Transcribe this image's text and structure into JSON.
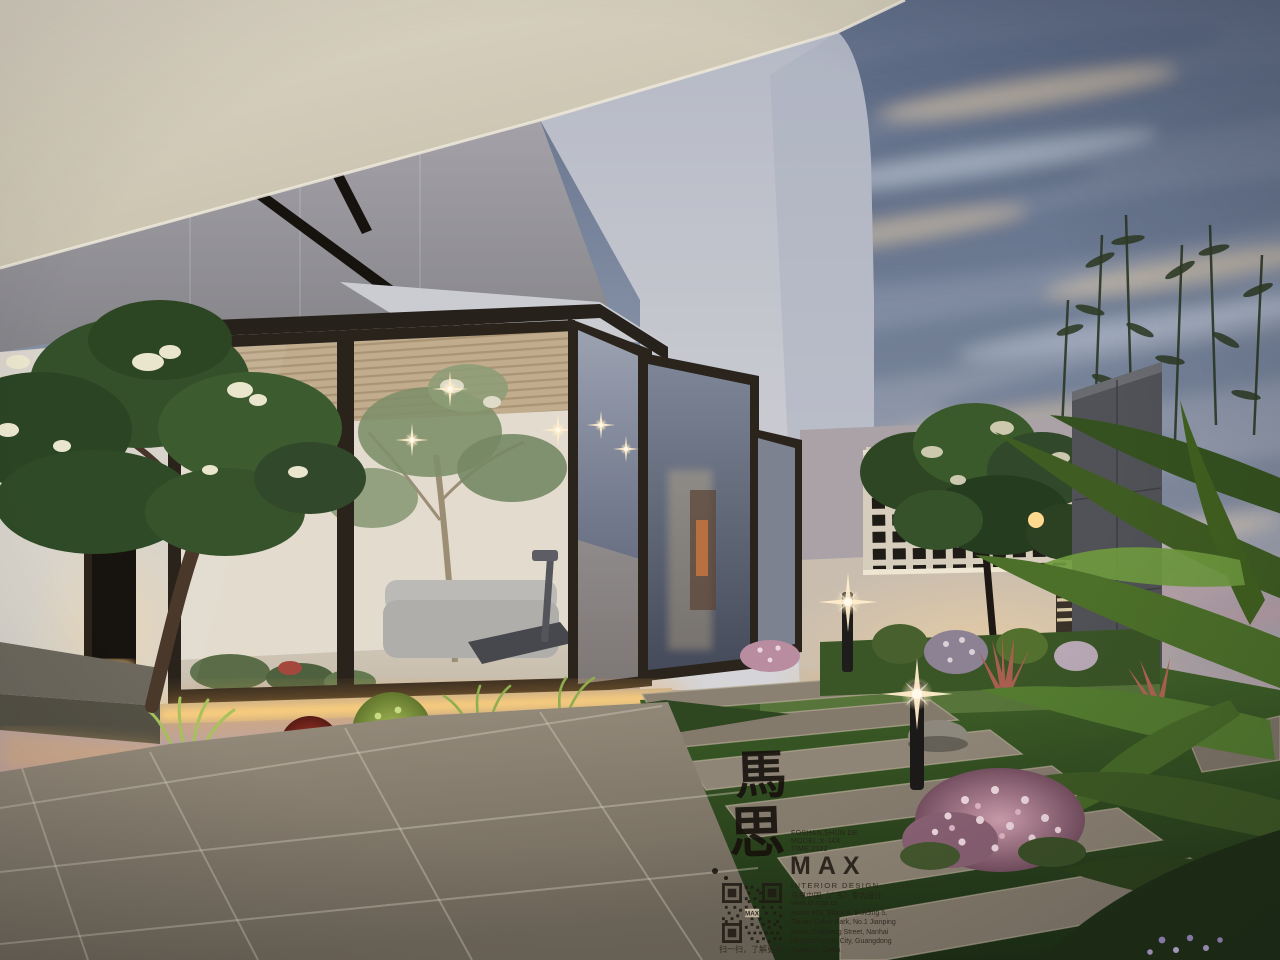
{
  "scene": {
    "description": "Dusk 3D architectural rendering: modern white villa with dark-framed glass sunroom, warm interior lighting, landscaped garden with stone plank path, breeze-block lattice wall, frangipani trees and tropical palms",
    "colors": {
      "sky_top": "#5f6c86",
      "sky_horizon_pink": "#caa49e",
      "eave_cream": "#d3ccba",
      "upper_wall_grey": "#9b999e",
      "white_volume": "#c3c6cf",
      "window_frame": "#2a241d",
      "interior_warm": "#e8e0d0",
      "led_glow": "#ffd27e",
      "grass": "#3c5626",
      "paver": "#948a7c",
      "lattice_frame": "#d7cdbc"
    }
  },
  "watermark": {
    "calligraphy_top": "馬",
    "calligraphy_bottom": "思",
    "project_line1": "FOSHAN,SHUN DE",
    "project_line2": "MODEL:X-14X",
    "project_line3": "TIME:2022",
    "logo": "MAX",
    "tagline_en": "INTERIOR DESIGN",
    "tagline_cn": "马思中国（广东）室内设计",
    "website": "www.id-max.cn",
    "address_lines": [
      "Room 803, Block A, Building 5,",
      "Tianan Cyber Park, No.1 Jianping",
      "Road, Guicheng Street, Nanhai",
      "District,Foshan City, Guangdong",
      "Province, China"
    ],
    "qr_caption": "扫一扫，了解更多"
  }
}
